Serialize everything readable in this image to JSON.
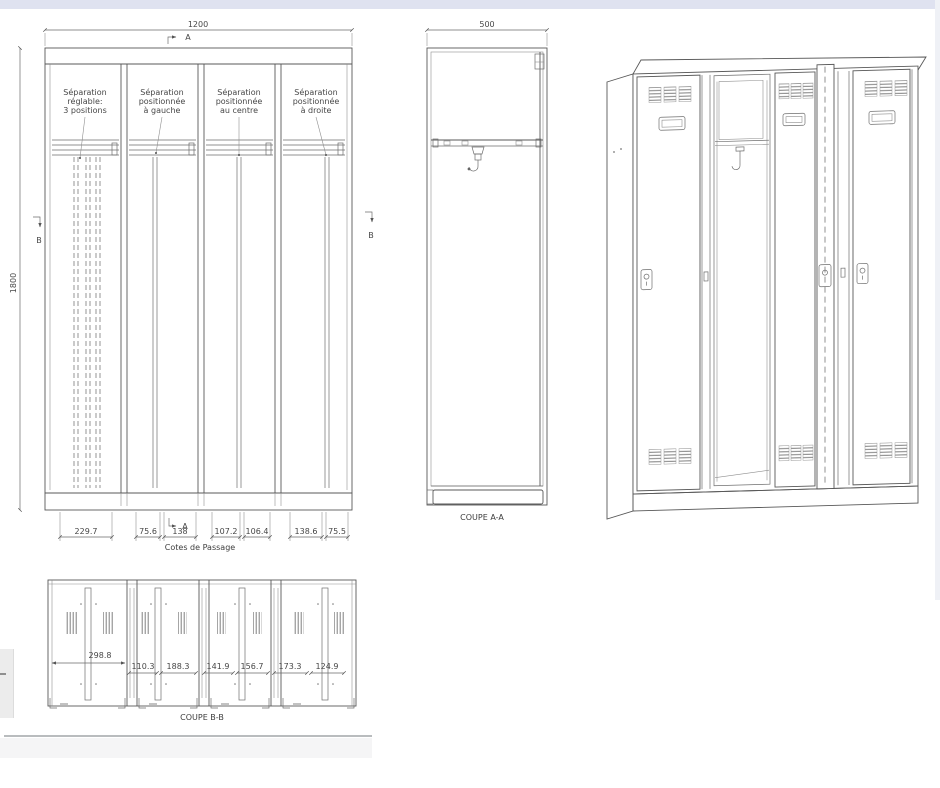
{
  "page": {
    "top_bar_color": "#dfe2f0",
    "line_color": "#585858"
  },
  "fv": {
    "width_dim": "1200",
    "height_dim": "1800",
    "marker_a": "A",
    "marker_b": "B",
    "labels": [
      {
        "l1": "Séparation",
        "l2": "réglable:",
        "l3": "3 positions"
      },
      {
        "l1": "Séparation",
        "l2": "positionnée",
        "l3": "à gauche"
      },
      {
        "l1": "Séparation",
        "l2": "positionnée",
        "l3": "au centre"
      },
      {
        "l1": "Séparation",
        "l2": "positionnée",
        "l3": "à droite"
      }
    ],
    "passage_dims": [
      "229.7",
      "75.6",
      "138",
      "107.2",
      "106.4",
      "138.6",
      "75.5"
    ],
    "caption": "Cotes de Passage"
  },
  "aa": {
    "width_dim": "500",
    "caption": "COUPE A-A"
  },
  "bb": {
    "main_dim": "298.8",
    "dims": [
      "110.3",
      "188.3",
      "141.9",
      "156.7",
      "173.3",
      "124.9"
    ],
    "caption": "COUPE B-B"
  }
}
